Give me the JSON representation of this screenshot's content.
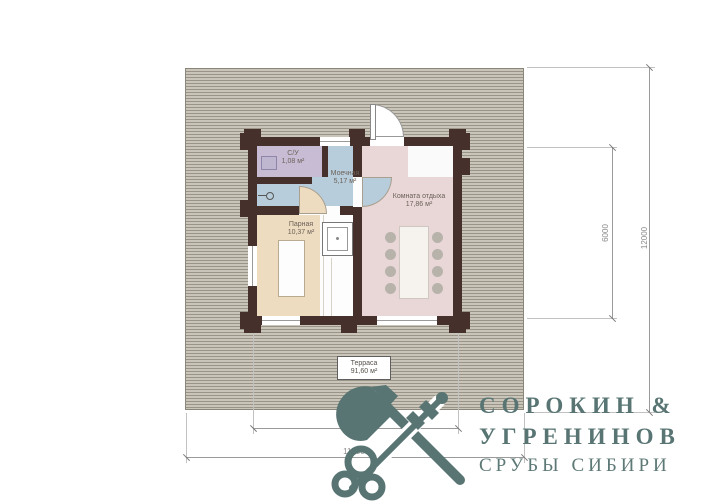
{
  "plan": {
    "rooms": [
      {
        "id": "su",
        "name": "С/У",
        "area": "1,08 м²"
      },
      {
        "id": "moechnaya",
        "name": "Моечная",
        "area": "5,17 м²"
      },
      {
        "id": "parnaya",
        "name": "Парная",
        "area": "10,37 м²"
      },
      {
        "id": "komnata-otdyha",
        "name": "Комната отдыха",
        "area": "17,86 м²"
      }
    ],
    "terrace": {
      "name": "Терраса",
      "area": "91,60 м²"
    },
    "dimensions": {
      "building_width": "7000",
      "terrace_width": "11500",
      "building_depth": "6000",
      "terrace_depth": "12000"
    }
  },
  "logo": {
    "line1": "СОРОКИН &",
    "line2": "УГРЕНИНОВ",
    "tagline": "СРУБЫ СИБИРИ",
    "icon": "axe-and-key-icon",
    "color": "#587573"
  },
  "colors": {
    "wall": "#46302c",
    "room_su": "#c8bcd4",
    "room_moechnaya": "#b7cddb",
    "room_parnaya": "#eddcc0",
    "room_otdyha": "#e9d7d7",
    "terrace_light": "#c9c5ba",
    "terrace_dark": "#999485"
  }
}
